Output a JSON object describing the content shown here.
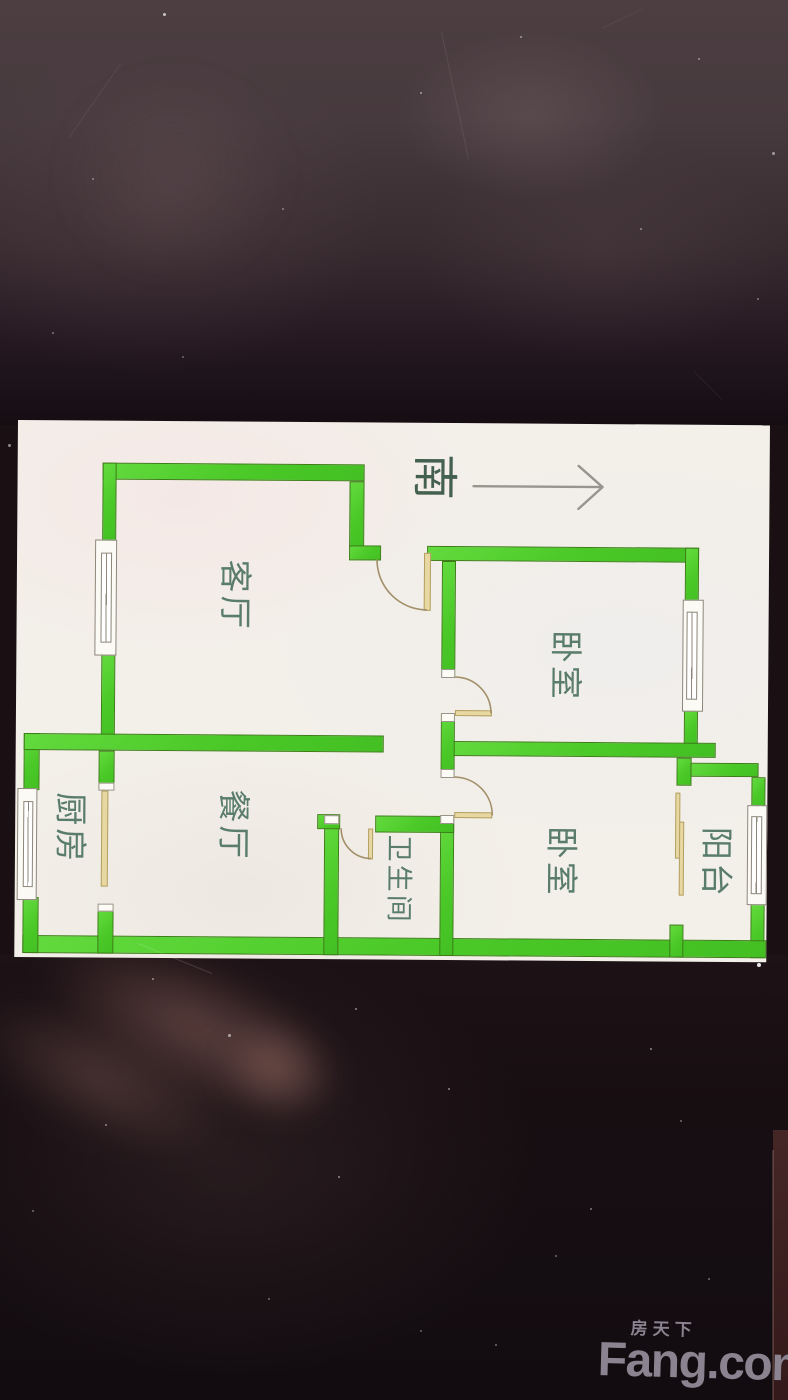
{
  "floor_plan": {
    "compass": {
      "label": "南",
      "arrow_direction": "right"
    },
    "rooms": [
      {
        "id": "living-room",
        "name": "客厅"
      },
      {
        "id": "bedroom-1",
        "name": "卧室"
      },
      {
        "id": "bedroom-2",
        "name": "卧室"
      },
      {
        "id": "dining-room",
        "name": "餐厅"
      },
      {
        "id": "kitchen",
        "name": "厨房"
      },
      {
        "id": "bathroom",
        "name": "卫生间"
      },
      {
        "id": "balcony",
        "name": "阳台"
      }
    ],
    "colors": {
      "wall_fill": "#4bc928",
      "wall_outline": "#3c7d17",
      "door": "#e7d7a0",
      "label_text": "#597c6b",
      "plan_background": "#f3efe9"
    }
  },
  "watermark": {
    "brand_cn": "房天下",
    "brand_en": "Fang.com",
    "color": "#8b8490"
  }
}
